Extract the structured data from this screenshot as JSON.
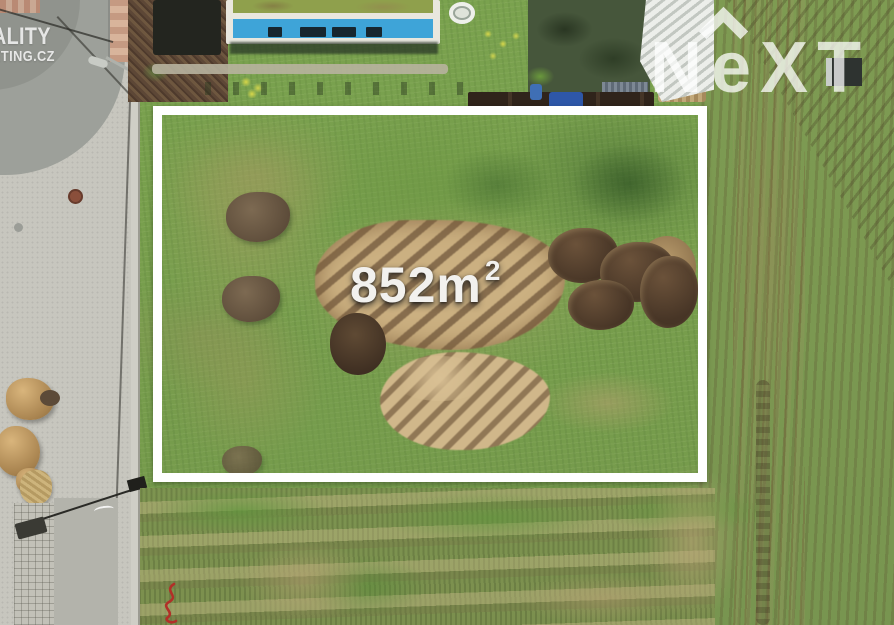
{
  "watermark": {
    "line1": "ALITY",
    "line2": "ETING.CZ"
  },
  "brand": {
    "letters": [
      "N",
      "e",
      "X",
      "T"
    ]
  },
  "plot": {
    "area": "852m",
    "area_sup": "2"
  },
  "colors": {
    "plot_border": "#ffffff",
    "area_text": "#f2f1ee",
    "watermark_text": "#ffffff",
    "red_mark": "#b13028",
    "grass": "#79a24f",
    "dirt": "#bfa379",
    "road": "#c7c6be"
  }
}
